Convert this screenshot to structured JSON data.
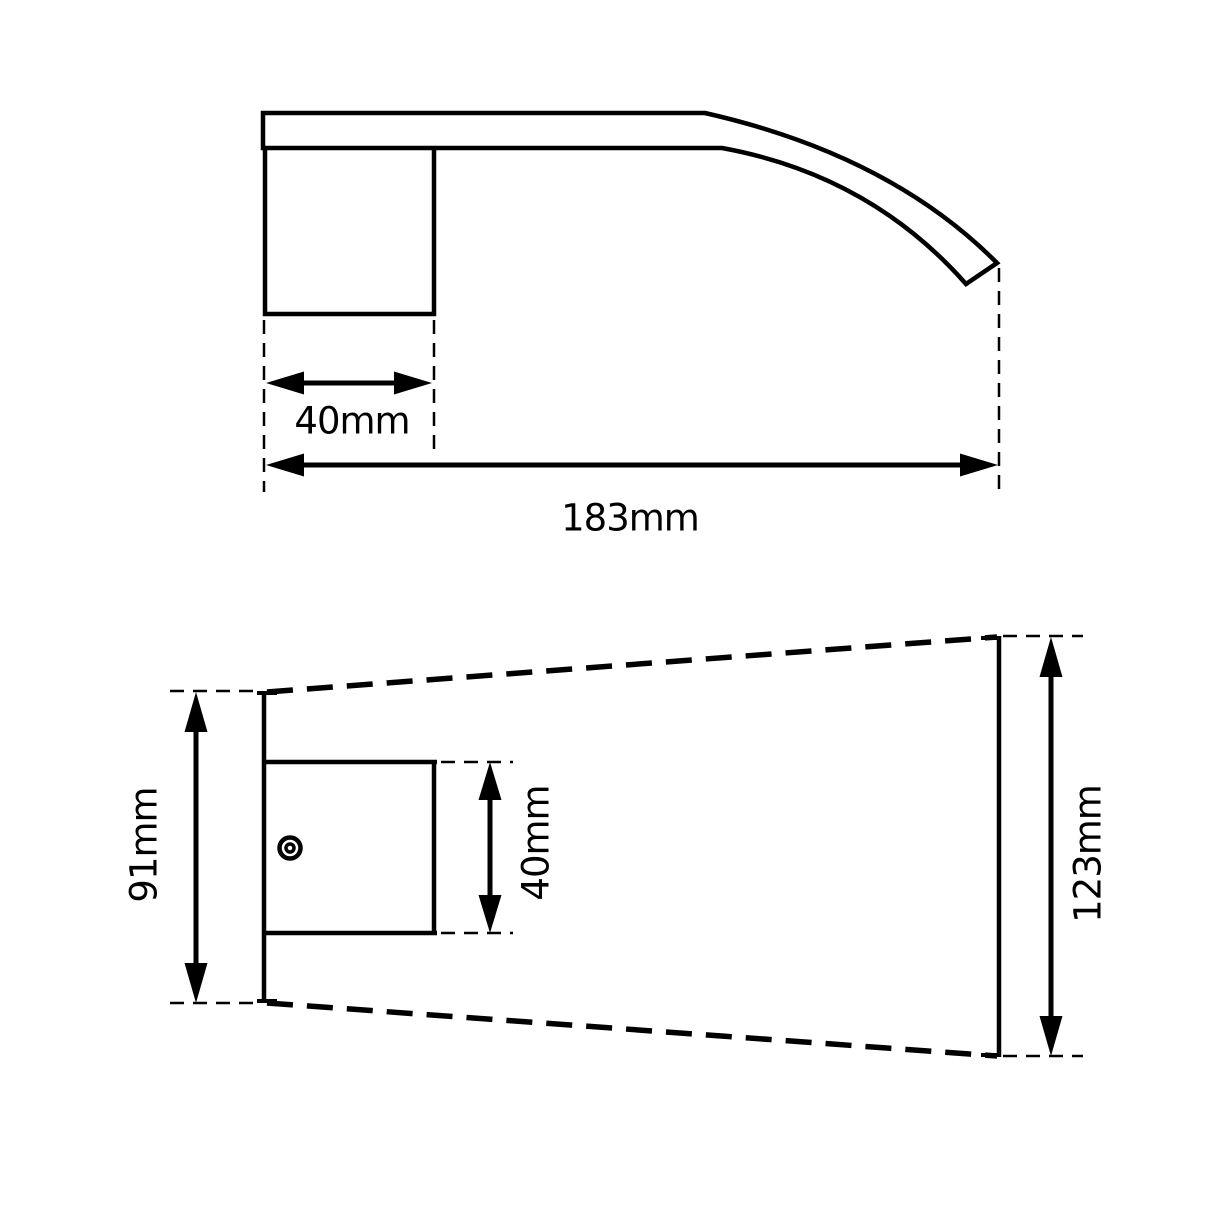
{
  "drawing": {
    "title": "wall-mounted curved spout dimension drawing",
    "ink_color": "#000000",
    "background_color": "#ffffff",
    "side_view": {
      "block_width_label": "40mm",
      "overall_length_label": "183mm"
    },
    "plan_view": {
      "plate_height_label": "91mm",
      "block_height_label": "40mm",
      "outlet_spread_label": "123mm"
    }
  }
}
